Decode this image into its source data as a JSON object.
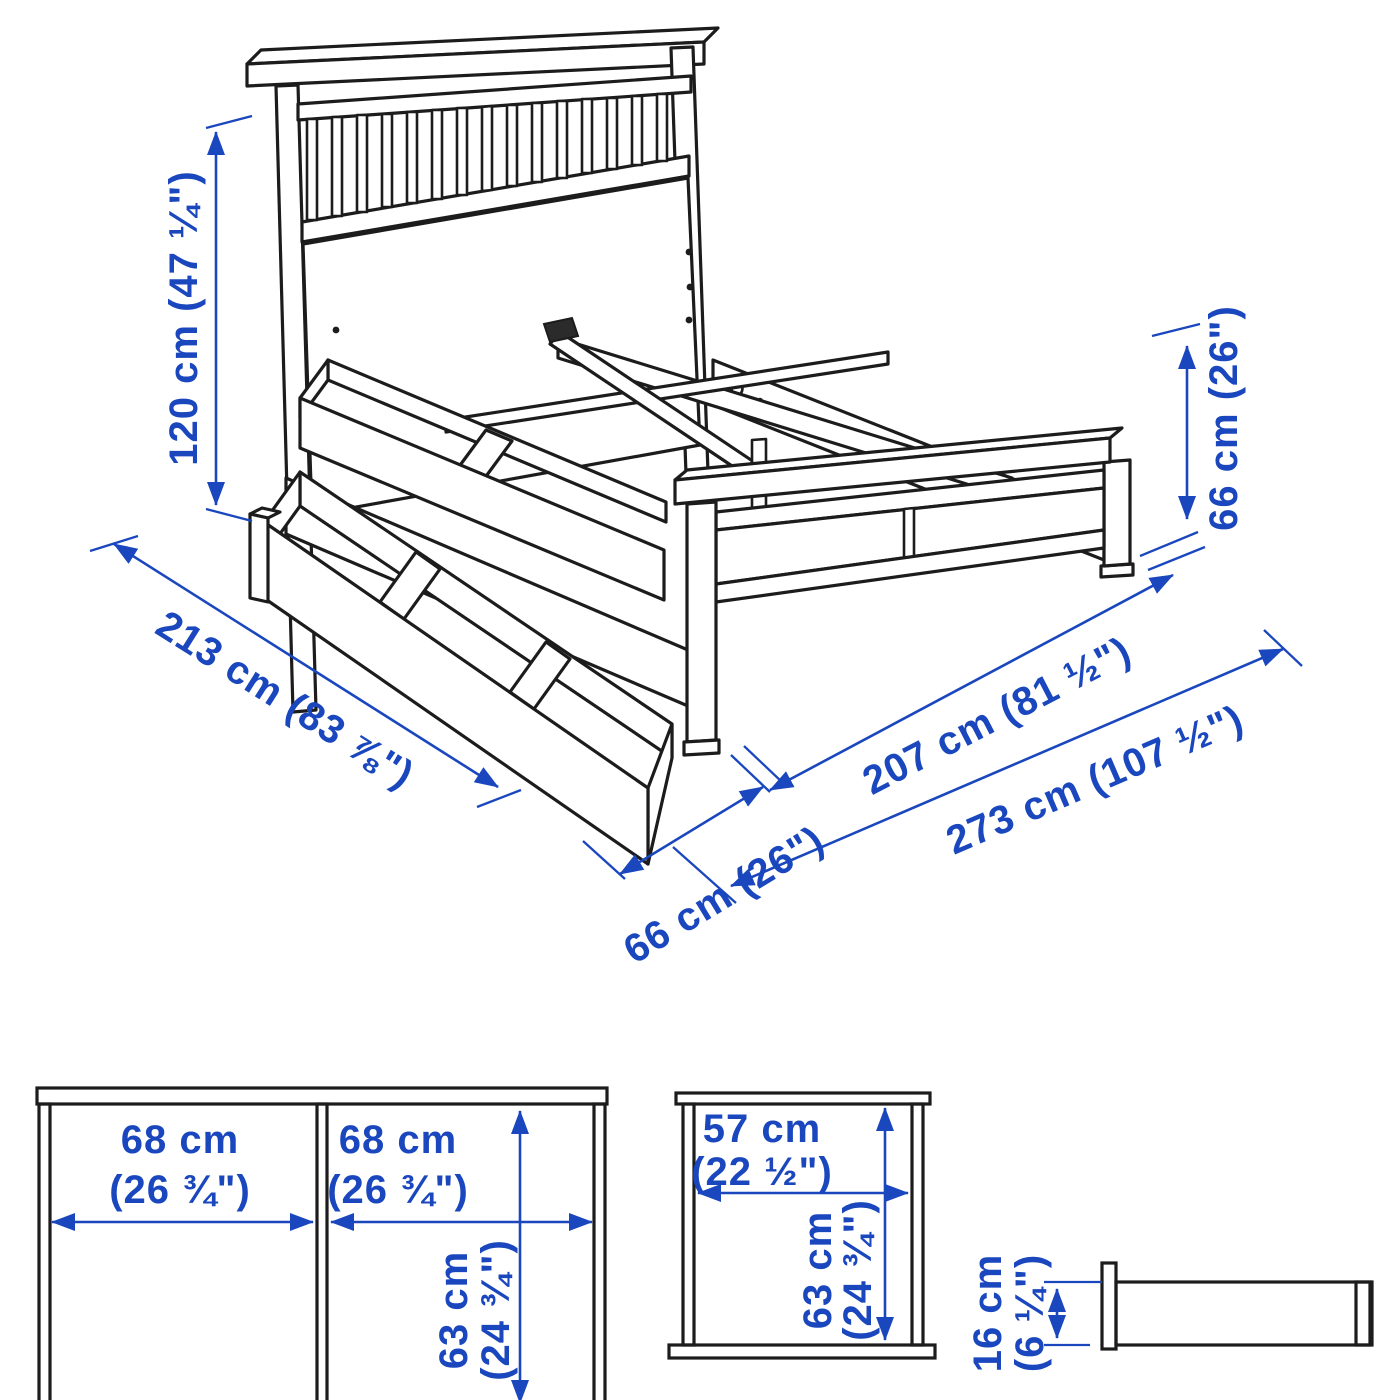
{
  "colors": {
    "dimension_blue": "#1a47be",
    "line_black": "#1c1c1c",
    "background": "#ffffff"
  },
  "main_view": {
    "description": "isometric line drawing of bed frame with headboard, footboard and two under-bed storage boxes, one pulled out",
    "dims": {
      "d120": "120 cm (47 ¼\")",
      "d213": "213 cm (83 ⅞\")",
      "d66_right": "66 cm (26\")",
      "d66_bottom": "66 cm (26\")",
      "d207": "207 cm (81 ½\")",
      "d273": "273 cm (107 ½\")"
    }
  },
  "box_front": {
    "w1a": "68 cm",
    "w1b": "(26 ¾\")",
    "w2a": "68 cm",
    "w2b": "(26 ¾\")",
    "da": "63 cm",
    "db": "(24 ¾\")"
  },
  "box_top": {
    "wa": "57 cm",
    "wb": "(22 ½\")",
    "da": "63 cm",
    "db": "(24 ¾\")"
  },
  "box_side": {
    "ha": "16 cm",
    "hb": "(6 ¼\")"
  }
}
